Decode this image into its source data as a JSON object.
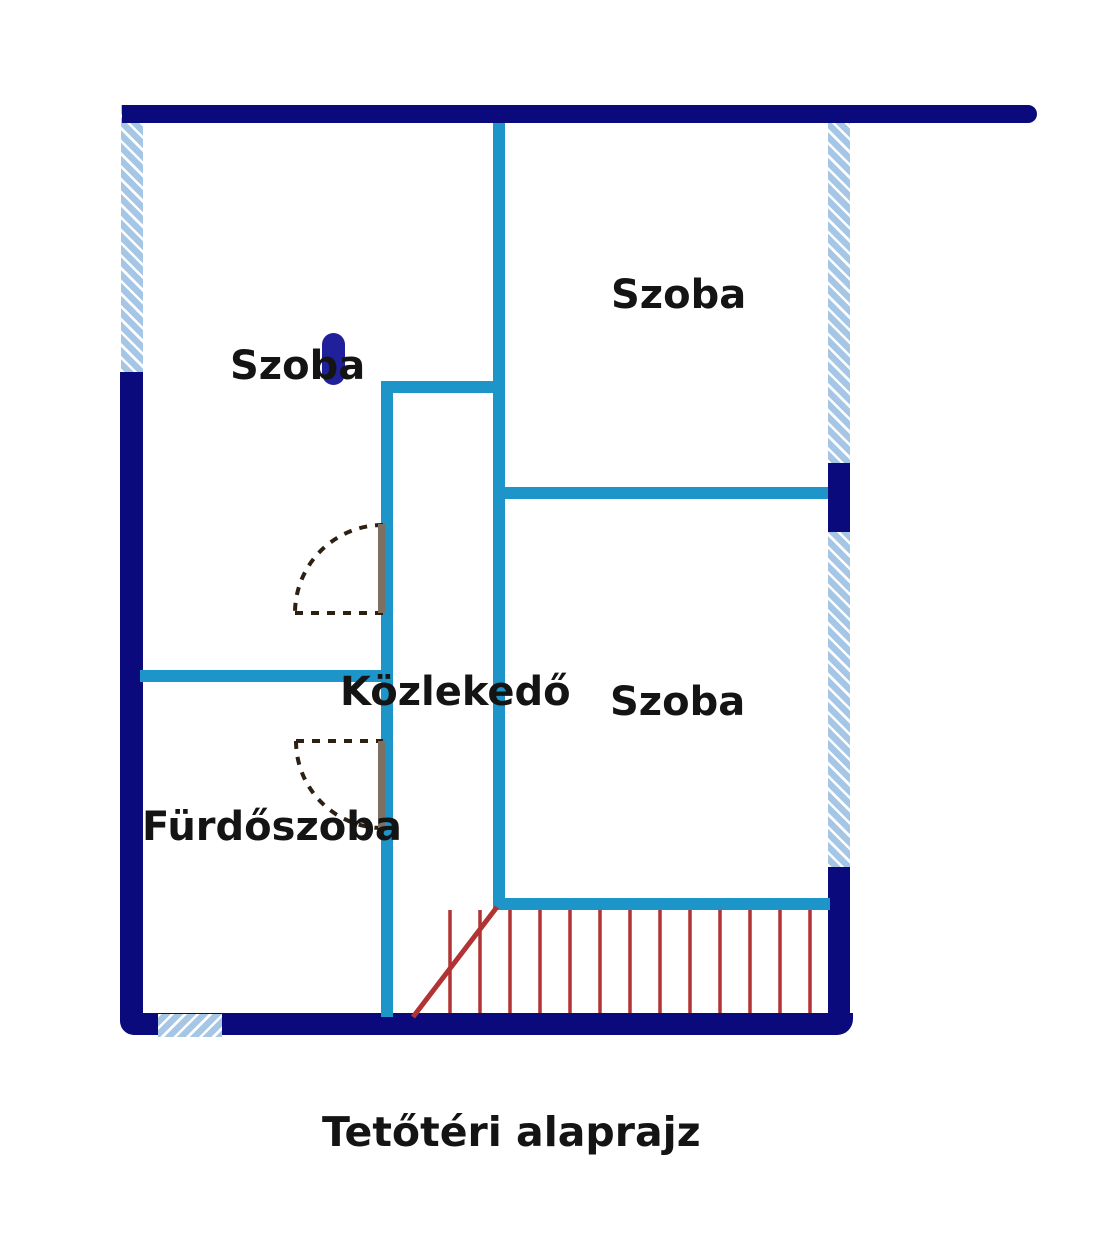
{
  "title": "Tetőtéri alaprajz",
  "rooms": [
    {
      "id": "szoba-left",
      "label": "Szoba"
    },
    {
      "id": "szoba-top-right",
      "label": "Szoba"
    },
    {
      "id": "szoba-right",
      "label": "Szoba"
    },
    {
      "id": "kozlekedo",
      "label": "Közlekedő"
    },
    {
      "id": "furdoszoba",
      "label": "Fürdőszoba"
    }
  ],
  "stairs": {
    "treads": 13
  },
  "colors": {
    "outer_wall_navy": "#0a0a7c",
    "inner_wall_cyan": "#1e95c8",
    "window_hatch_blue": "#a6c6e6",
    "window_hatch_stripe": "#fdfeff",
    "stair_red": "#b23333",
    "door_leaf_brown": "#7d7060",
    "door_swing_dash": "#2d1f12",
    "column_blue": "#20209b",
    "text": "#141414"
  }
}
